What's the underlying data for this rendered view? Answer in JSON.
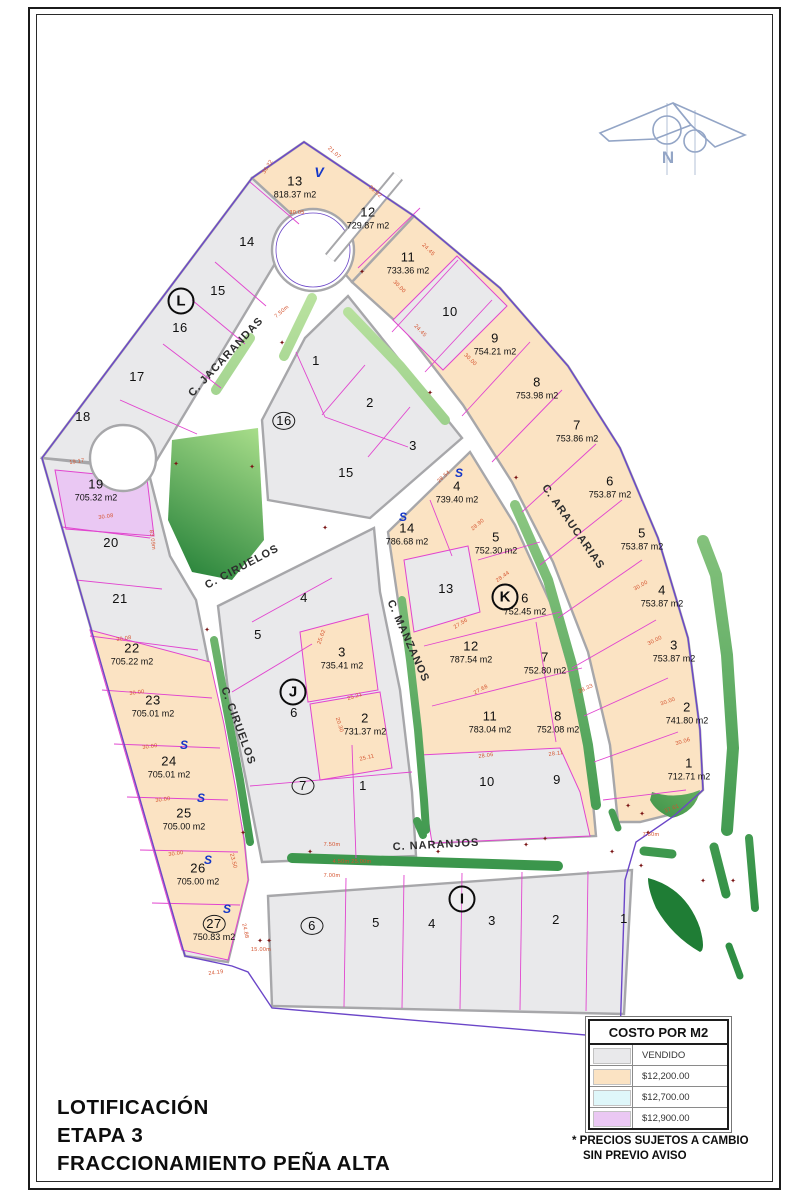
{
  "title": {
    "lines": [
      "LOTIFICACIÓN",
      "ETAPA 3",
      "FRACCIONAMIENTO PEÑA ALTA"
    ]
  },
  "north": {
    "label": "N"
  },
  "legend": {
    "title": "COSTO POR M2",
    "rows": [
      {
        "label": "VENDIDO",
        "color": "#e9e9eb"
      },
      {
        "label": "$12,200.00",
        "color": "#fbe3c3"
      },
      {
        "label": "$12,700.00",
        "color": "#dff7fa"
      },
      {
        "label": "$12,900.00",
        "color": "#eac8f3"
      }
    ],
    "notes": [
      "* PRECIOS SUJETOS A CAMBIO",
      "SIN PREVIO AVISO"
    ]
  },
  "colors": {
    "lot_peach": "#fbe3c3",
    "lot_gray": "#e9e9eb",
    "lot_purple": "#eac8f3",
    "lot_cyan": "#dff7fa",
    "street_casing": "#a7a7aa",
    "median_light": "#c4e8a6",
    "median_dark": "#2f8f44",
    "magenta": "#e145cf",
    "boundary_violet": "#6b46c8",
    "dim_red": "#d4512c",
    "marker_blue": "#1537c8",
    "cross_red": "#7a1515"
  },
  "map": {
    "streets": [
      {
        "name": "C. JACARANDAS",
        "x": 226,
        "y": 357,
        "rot": -47
      },
      {
        "name": "C. CIRUELOS",
        "x": 242,
        "y": 567,
        "rot": -28
      },
      {
        "name": "C. CIRUELOS",
        "x": 238,
        "y": 726,
        "rot": 70
      },
      {
        "name": "C. MANZANOS",
        "x": 408,
        "y": 641,
        "rot": 66
      },
      {
        "name": "C. ARAUCARIAS",
        "x": 573,
        "y": 527,
        "rot": 55
      },
      {
        "name": "C. NARANJOS",
        "x": 436,
        "y": 845,
        "rot": -3
      }
    ],
    "block_letters": [
      {
        "label": "L",
        "x": 181,
        "y": 301
      },
      {
        "label": "J",
        "x": 293,
        "y": 692
      },
      {
        "label": "K",
        "x": 505,
        "y": 597
      },
      {
        "label": "I",
        "x": 462,
        "y": 899
      }
    ],
    "lots": [
      {
        "block": "L",
        "num": "13",
        "area": "818.37 m2",
        "x": 295,
        "y": 186
      },
      {
        "block": "L",
        "num": "14",
        "x": 247,
        "y": 242
      },
      {
        "block": "L",
        "num": "15",
        "x": 218,
        "y": 291
      },
      {
        "block": "L",
        "num": "16",
        "x": 180,
        "y": 328
      },
      {
        "block": "L",
        "num": "17",
        "x": 137,
        "y": 377
      },
      {
        "block": "L",
        "num": "18",
        "x": 83,
        "y": 417
      },
      {
        "block": "arc",
        "num": "12",
        "area": "729.87 m2",
        "x": 368,
        "y": 217
      },
      {
        "block": "arc",
        "num": "11",
        "area": "733.36 m2",
        "x": 408,
        "y": 262
      },
      {
        "block": "arc",
        "num": "10",
        "x": 450,
        "y": 312
      },
      {
        "block": "arc",
        "num": "9",
        "area": "754.21 m2",
        "x": 495,
        "y": 343
      },
      {
        "block": "arc",
        "num": "8",
        "area": "753.98 m2",
        "x": 537,
        "y": 387
      },
      {
        "block": "arc",
        "num": "7",
        "area": "753.86 m2",
        "x": 577,
        "y": 430
      },
      {
        "block": "arc",
        "num": "6",
        "area": "753.87 m2",
        "x": 610,
        "y": 486
      },
      {
        "block": "arc",
        "num": "5",
        "area": "753.87 m2",
        "x": 642,
        "y": 538
      },
      {
        "block": "arc",
        "num": "4",
        "area": "753.87 m2",
        "x": 662,
        "y": 595
      },
      {
        "block": "arc",
        "num": "3",
        "area": "753.87 m2",
        "x": 674,
        "y": 650
      },
      {
        "block": "arc",
        "num": "2",
        "area": "741.80 m2",
        "x": 687,
        "y": 712
      },
      {
        "block": "arc",
        "num": "1",
        "area": "712.71 m2",
        "x": 689,
        "y": 768
      },
      {
        "block": "16",
        "num": "16",
        "circled": true,
        "x": 284,
        "y": 421
      },
      {
        "block": "16",
        "num": "1",
        "x": 316,
        "y": 361
      },
      {
        "block": "16",
        "num": "2",
        "x": 370,
        "y": 403
      },
      {
        "block": "16",
        "num": "3",
        "x": 413,
        "y": 446
      },
      {
        "block": "16",
        "num": "15",
        "x": 346,
        "y": 473
      },
      {
        "block": "K",
        "num": "4",
        "area": "739.40 m2",
        "x": 457,
        "y": 491
      },
      {
        "block": "K",
        "num": "14",
        "area": "786.68 m2",
        "x": 407,
        "y": 533
      },
      {
        "block": "K",
        "num": "5",
        "area": "752.30 m2",
        "x": 496,
        "y": 542
      },
      {
        "block": "K",
        "num": "13",
        "x": 446,
        "y": 589
      },
      {
        "block": "K",
        "num": "6",
        "area": "752.45 m2",
        "x": 525,
        "y": 603
      },
      {
        "block": "K",
        "num": "12",
        "area": "787.54 m2",
        "x": 471,
        "y": 651
      },
      {
        "block": "K",
        "num": "7",
        "area": "752.80 m2",
        "x": 545,
        "y": 662
      },
      {
        "block": "K",
        "num": "11",
        "area": "783.04 m2",
        "x": 490,
        "y": 721
      },
      {
        "block": "K",
        "num": "8",
        "area": "752.08 m2",
        "x": 558,
        "y": 721
      },
      {
        "block": "K",
        "num": "10",
        "x": 487,
        "y": 782
      },
      {
        "block": "K",
        "num": "9",
        "x": 557,
        "y": 780
      },
      {
        "block": "J",
        "num": "4",
        "x": 304,
        "y": 598
      },
      {
        "block": "J",
        "num": "5",
        "x": 258,
        "y": 635
      },
      {
        "block": "J",
        "num": "3",
        "area": "735.41 m2",
        "x": 342,
        "y": 657
      },
      {
        "block": "J",
        "num": "6",
        "x": 294,
        "y": 713
      },
      {
        "block": "J",
        "num": "2",
        "area": "731.37 m2",
        "x": 365,
        "y": 723
      },
      {
        "block": "J",
        "num": "7",
        "circled": true,
        "x": 303,
        "y": 786
      },
      {
        "block": "J",
        "num": "1",
        "x": 363,
        "y": 786
      },
      {
        "block": "left",
        "num": "19",
        "area": "705.32 m2",
        "x": 96,
        "y": 489
      },
      {
        "block": "left",
        "num": "20",
        "x": 111,
        "y": 543
      },
      {
        "block": "left",
        "num": "21",
        "x": 120,
        "y": 599
      },
      {
        "block": "left",
        "num": "22",
        "area": "705.22 m2",
        "x": 132,
        "y": 653
      },
      {
        "block": "left",
        "num": "23",
        "area": "705.01 m2",
        "x": 153,
        "y": 705
      },
      {
        "block": "left",
        "num": "24",
        "area": "705.01 m2",
        "x": 169,
        "y": 766
      },
      {
        "block": "left",
        "num": "25",
        "area": "705.00 m2",
        "x": 184,
        "y": 818
      },
      {
        "block": "left",
        "num": "26",
        "area": "705.00 m2",
        "x": 198,
        "y": 873
      },
      {
        "block": "left",
        "num": "27",
        "circled": true,
        "area": "750.83 m2",
        "x": 214,
        "y": 929
      },
      {
        "block": "I",
        "num": "6",
        "circled": true,
        "x": 312,
        "y": 926
      },
      {
        "block": "I",
        "num": "5",
        "x": 376,
        "y": 923
      },
      {
        "block": "I",
        "num": "4",
        "x": 432,
        "y": 924
      },
      {
        "block": "I",
        "num": "3",
        "x": 492,
        "y": 921
      },
      {
        "block": "I",
        "num": "2",
        "x": 556,
        "y": 920
      },
      {
        "block": "I",
        "num": "1",
        "x": 624,
        "y": 919
      }
    ],
    "sold_markers": {
      "glyph": "S",
      "positions": [
        [
          459,
          473
        ],
        [
          403,
          517
        ],
        [
          184,
          745
        ],
        [
          201,
          798
        ],
        [
          208,
          860
        ],
        [
          227,
          909
        ]
      ]
    },
    "v_marker": {
      "glyph": "V",
      "x": 319,
      "y": 172
    },
    "crosses": {
      "glyph": "✦",
      "positions": [
        [
          362,
          272
        ],
        [
          282,
          343
        ],
        [
          252,
          467
        ],
        [
          325,
          528
        ],
        [
          430,
          393
        ],
        [
          516,
          478
        ],
        [
          207,
          630
        ],
        [
          243,
          833
        ],
        [
          310,
          852
        ],
        [
          438,
          852
        ],
        [
          526,
          845
        ],
        [
          612,
          852
        ],
        [
          628,
          806
        ],
        [
          176,
          464
        ],
        [
          545,
          839
        ],
        [
          642,
          814
        ],
        [
          648,
          833
        ],
        [
          641,
          866
        ],
        [
          703,
          881
        ],
        [
          733,
          881
        ],
        [
          260,
          941
        ],
        [
          269,
          941
        ]
      ]
    },
    "dims": [
      [
        "30.05",
        297,
        213,
        0
      ],
      [
        "36.22",
        268,
        167,
        -58
      ],
      [
        "21.07",
        334,
        153,
        42
      ],
      [
        "33.92",
        375,
        192,
        42
      ],
      [
        "24.45",
        428,
        250,
        45
      ],
      [
        "30.00",
        399,
        287,
        46
      ],
      [
        "24.45",
        420,
        331,
        46
      ],
      [
        "30.00",
        470,
        360,
        44
      ],
      [
        "28.54",
        444,
        477,
        -42
      ],
      [
        "28.90",
        478,
        525,
        -40
      ],
      [
        "28.44",
        503,
        577,
        -35
      ],
      [
        "27.56",
        461,
        624,
        -32
      ],
      [
        "27.68",
        481,
        690,
        -28
      ],
      [
        "28.06",
        486,
        756,
        -8
      ],
      [
        "28.11",
        556,
        754,
        -8
      ],
      [
        "28.33",
        586,
        689,
        -25
      ],
      [
        "25.62",
        322,
        637,
        -70
      ],
      [
        "25.21",
        355,
        697,
        -18
      ],
      [
        "25.11",
        367,
        758,
        -14
      ],
      [
        "20.30",
        339,
        725,
        72
      ],
      [
        "19.17",
        77,
        462,
        -8
      ],
      [
        "30.08",
        106,
        517,
        -8
      ],
      [
        "30.08",
        124,
        639,
        -8
      ],
      [
        "30.00",
        137,
        693,
        -8
      ],
      [
        "30.00",
        150,
        747,
        -8
      ],
      [
        "30.00",
        163,
        800,
        -8
      ],
      [
        "30.00",
        176,
        854,
        -8
      ],
      [
        "24.88",
        245,
        931,
        78
      ],
      [
        "23.50",
        233,
        861,
        76
      ],
      [
        "24.19",
        216,
        973,
        -8
      ],
      [
        "15.00m",
        261,
        950,
        0
      ],
      [
        "7.00m",
        332,
        876,
        0
      ],
      [
        "4.50m 25.00m",
        352,
        862,
        0
      ],
      [
        "7.50m",
        332,
        845,
        0
      ],
      [
        "7.50m",
        651,
        835,
        0
      ],
      [
        "83.09m",
        152,
        540,
        82
      ],
      [
        "37.61",
        672,
        809,
        -22
      ],
      [
        "30.06",
        683,
        742,
        -16
      ],
      [
        "30.00",
        641,
        586,
        -30
      ],
      [
        "30.00",
        655,
        641,
        -26
      ],
      [
        "30.00",
        668,
        702,
        -20
      ],
      [
        "7.50m",
        282,
        312,
        -40
      ]
    ]
  }
}
